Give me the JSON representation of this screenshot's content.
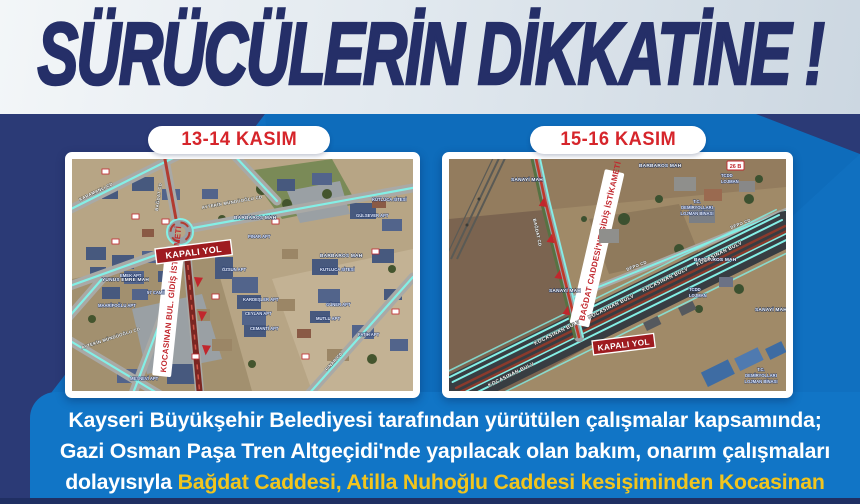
{
  "colors": {
    "background_blue": "#1070c0",
    "navy": "#2b3a76",
    "title_navy": "#252f68",
    "header_background": "#e8eef4",
    "date_red": "#d6252b",
    "map_red": "#c1272d",
    "closed_ribbon_red": "#9e1b20",
    "highlight_yellow": "#f2c51e",
    "road_cyan": "#84efe6"
  },
  "title": "SÜRÜCÜLERİN DİKKATİNE !",
  "maps": {
    "left": {
      "date": "13-14 KASIM",
      "closed_road": "KAPALI YOL",
      "direction_banner": "KOCASINAN BUL. GİDİŞ İSTİKAMETİ",
      "streets": {
        "bagdat": "BAĞDAT CD",
        "karamanli": "KARAMANLI CD",
        "pinar": "PINAR CD",
        "aytekin": "AYTEKİN MÜNDÜOĞLU CD"
      },
      "areas": {
        "barbaros": "BARBAROS MAH",
        "yunus_emre": "YUNUS EMRE MAH"
      },
      "places": {
        "cami": "57 CAMİİ",
        "kutluca": "KUTLUCA SİTESİ",
        "gulsever": "GÜLSEVER APT",
        "ozsun": "ÖZSUN APT",
        "kardesler": "KARDEŞLER APT",
        "ceylan": "CEYLAN APT",
        "cemanti": "CEMANTİ APT",
        "guner": "GÜNER APT",
        "mutlu": "MUTLU APT",
        "fatih": "FATİH APT",
        "emek": "EMEK APT",
        "mesnevi": "MESNEVİ APT",
        "maarifoglu": "MAARİFOĞLU APT",
        "pinar_apt": "PINAR APT"
      }
    },
    "right": {
      "date": "15-16 KASIM",
      "closed_road": "KAPALI YOL",
      "direction_banner": "BAĞDAT CADDESİ'NE GİDİŞ İSTİKAMETİ",
      "streets": {
        "kocasinan": "KOCASINAN BULV",
        "depo": "DEPO CD",
        "bagdat": "BAĞDAT CD"
      },
      "areas": {
        "barbaros": "BARBAROS MAH",
        "sanayi": "SANAYİ MAH"
      },
      "places": {
        "tcdd_1": "TCDD",
        "tcdd_2": "LOJMAN",
        "dy_1": "T.C.",
        "dy_2": "DEMİRYOLLARI",
        "dy_3": "LOJMAN BİNASI",
        "badge": "26 B"
      }
    }
  },
  "announcement": {
    "line1": "Kayseri Büyükşehir Belediyesi tarafından yürütülen çalışmalar kapsamında;",
    "line2": "Gazi Osman Paşa Tren Altgeçidi'nde yapılacak olan bakım, onarım çalışmaları",
    "line3_white": "dolayısıyla",
    "line3_yellow": "Bağdat Caddesi, Atilla Nuhoğlu Caddesi kesişiminden Kocasinan"
  }
}
